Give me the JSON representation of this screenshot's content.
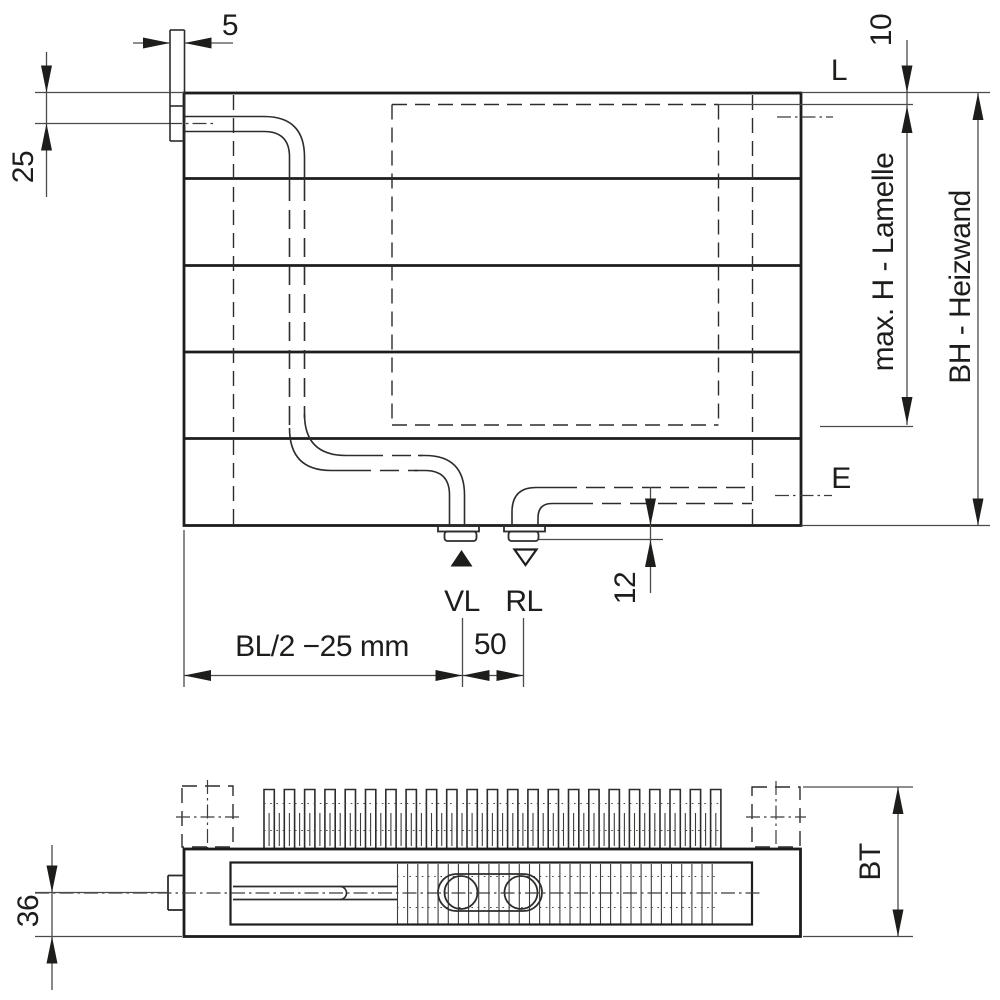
{
  "drawing": {
    "background": "#ffffff",
    "line_color": "#1d1d1b",
    "front_view": {
      "dim_bracket_thickness": "5",
      "dim_top_edge_to_pipe_center": "25",
      "label_top_fixing_level": "L",
      "dim_top_edge_to_lamelle": "10",
      "dim_max_lamelle_height": "max. H - Lamelle",
      "dim_heizwand_height": "BH - Heizwand",
      "label_vent_level": "E",
      "dim_stub_protrusion": "12",
      "label_supply": "VL",
      "label_return": "RL",
      "dim_left_edge_to_supply": "BL/2 −25 mm",
      "dim_supply_to_return_spacing": "50"
    },
    "plan_view": {
      "dim_centerline_to_front": "36",
      "dim_build_depth": "BT"
    },
    "symbols": {
      "supply_marker": "filled-triangle-up",
      "return_marker": "open-triangle-down"
    }
  }
}
